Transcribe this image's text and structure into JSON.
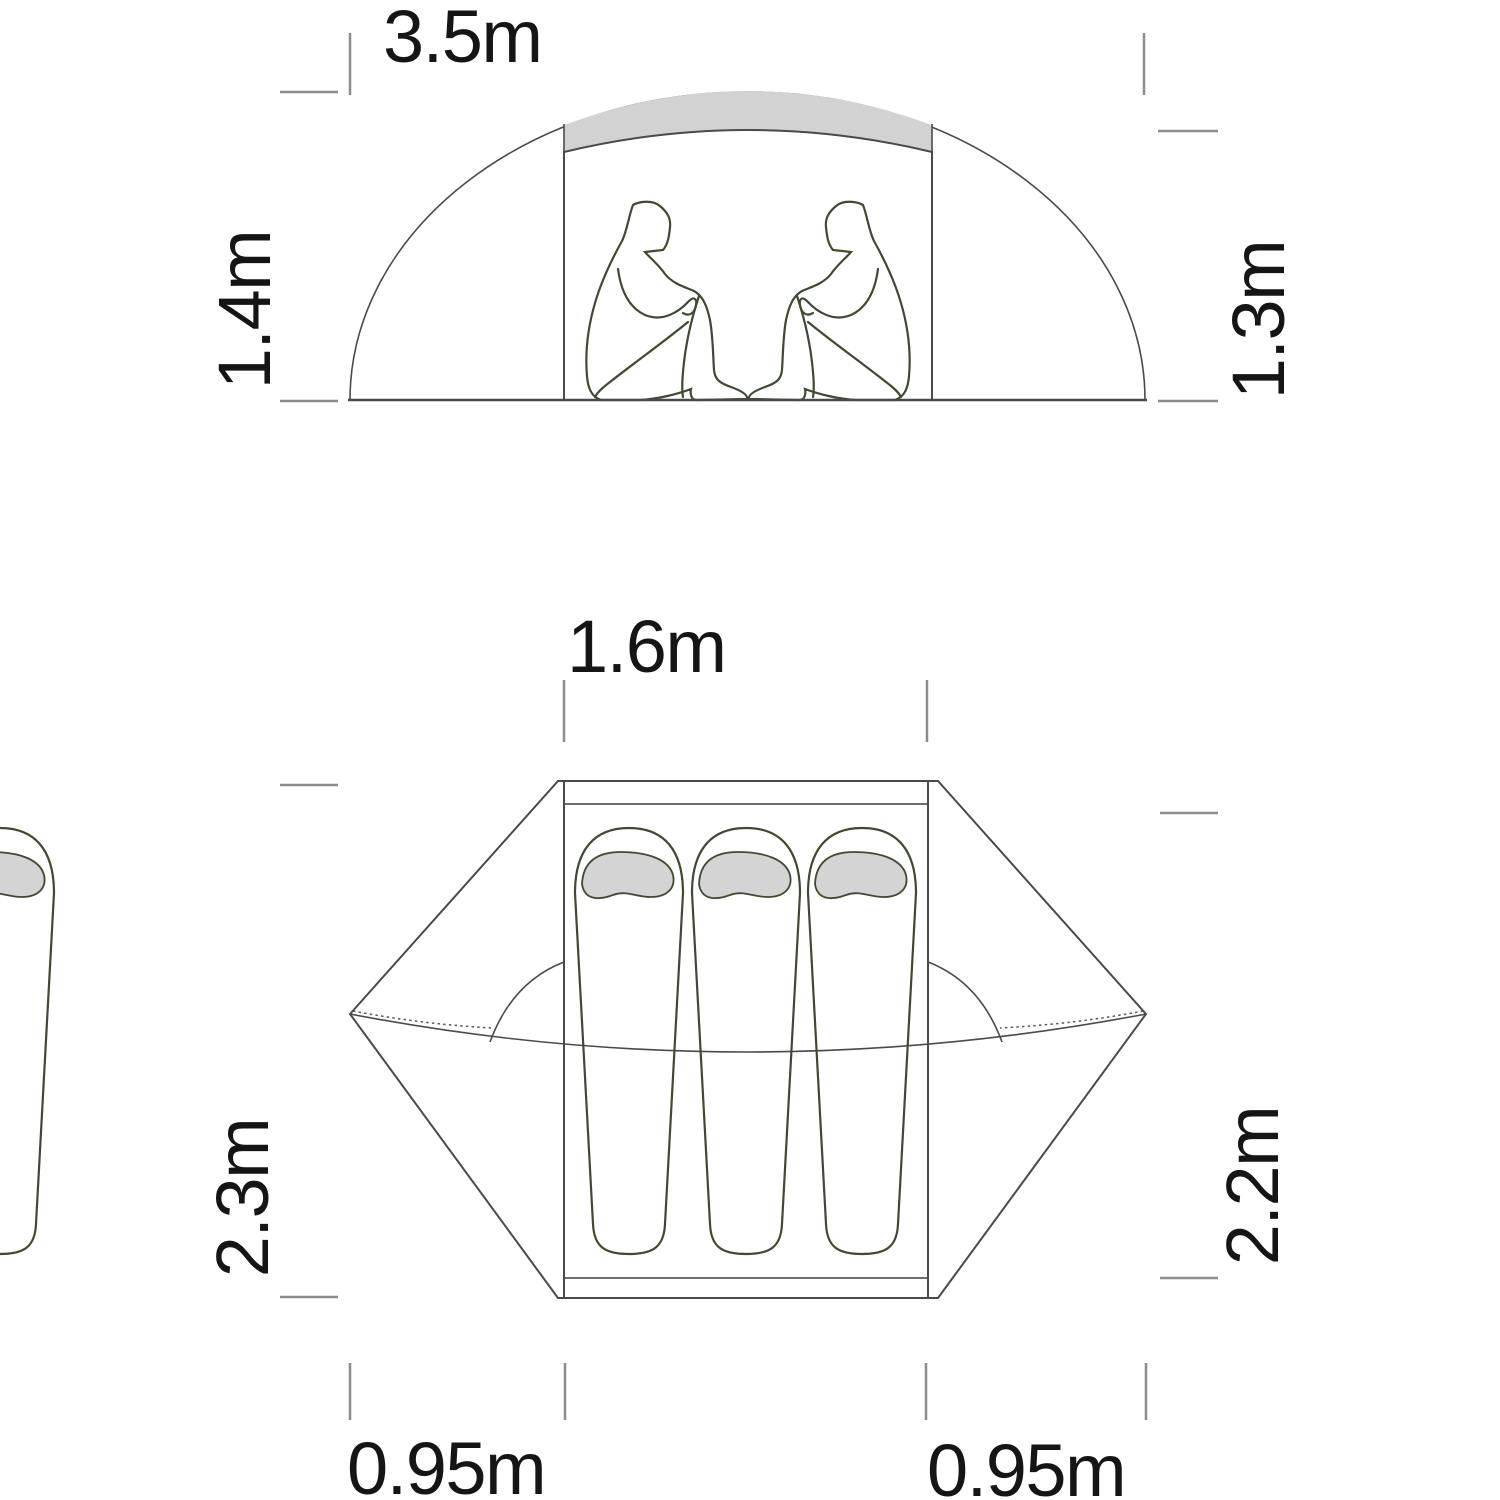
{
  "diagram": {
    "title_semantic": "tent-dimensions-diagram",
    "side_view": {
      "width_label": "3.5m",
      "outer_height_label": "1.4m",
      "inner_height_label": "1.3m",
      "occupants_shown": 2
    },
    "floor_plan": {
      "inner_width_label": "1.6m",
      "outer_length_label": "2.3m",
      "inner_length_label": "2.2m",
      "left_vestibule_label": "0.95m",
      "right_vestibule_label": "0.95m",
      "sleeping_bags_shown": 3
    },
    "colors": {
      "fly_gray": "#dbdbdb",
      "fly_band_gray": "#d2d2d2",
      "floorplan_fly_gray": "#d9d9d9",
      "inner_light_gray": "#ededed",
      "strip_gray": "#d9d9d9",
      "hood_gray": "#d4d4d4",
      "olive_green": "#6f8052",
      "outline_dark": "#4a4a4a",
      "tick_gray": "#8c8c8c",
      "text_black": "#151515"
    }
  }
}
